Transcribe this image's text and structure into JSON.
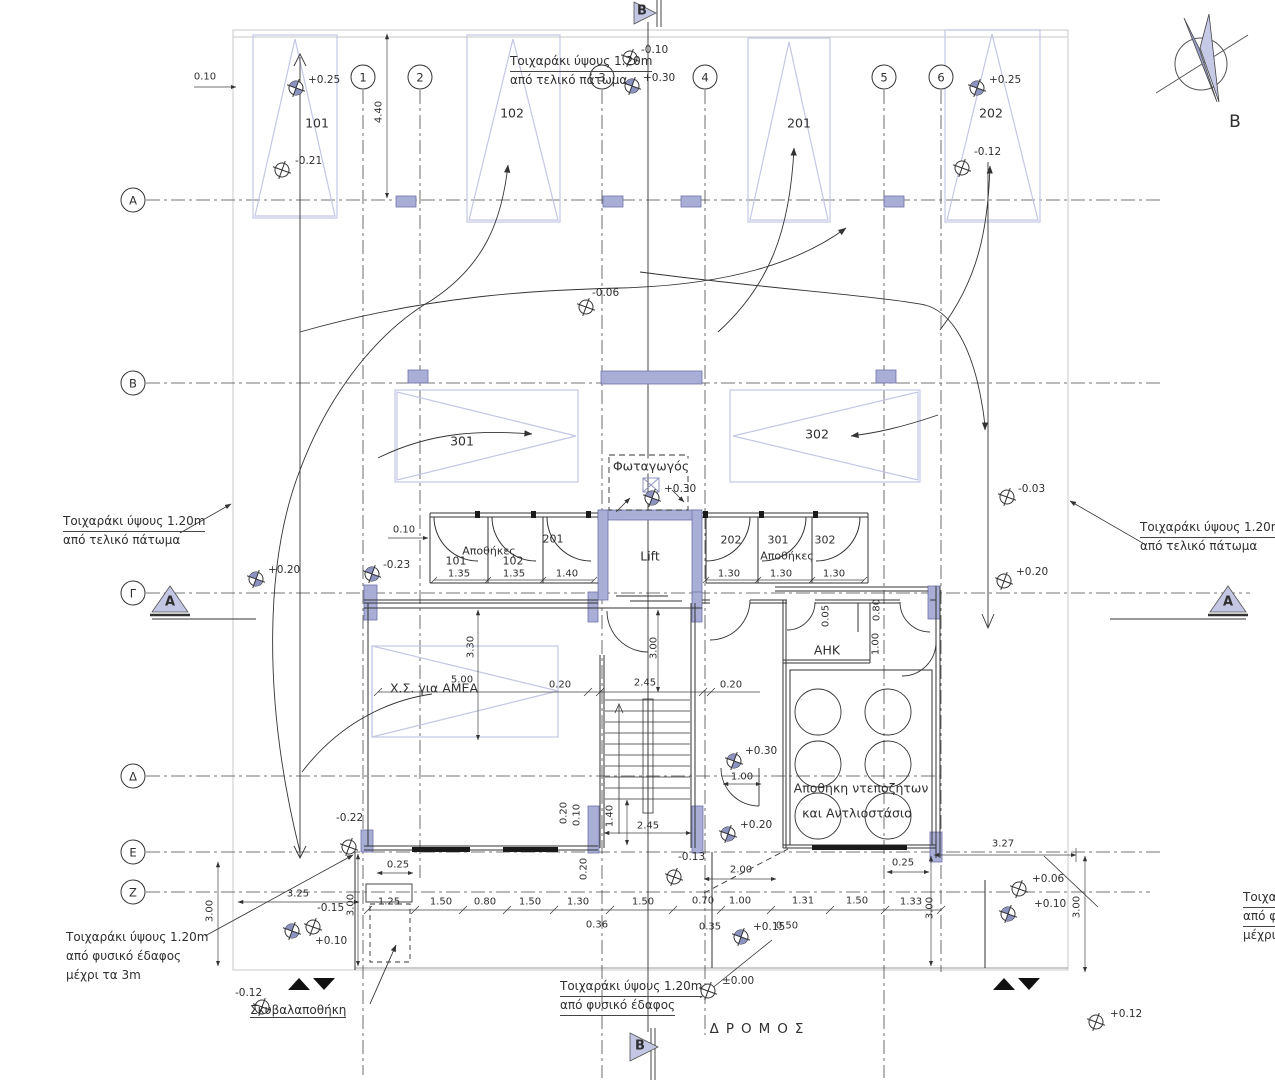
{
  "north": {
    "label": "Β"
  },
  "road_label": "ΔΡΟΜΟΣ",
  "section_markers": {
    "top": "Β",
    "bottom": "Β",
    "left": "Α",
    "right": "Α"
  },
  "grid": {
    "cols": [
      "1",
      "2",
      "3",
      "4",
      "5",
      "6"
    ],
    "rows": [
      "Α",
      "Β",
      "Γ",
      "Δ",
      "Ε",
      "Ζ"
    ]
  },
  "parking": {
    "p101": "101",
    "p102": "102",
    "p201": "201",
    "p202": "202",
    "p301": "301",
    "p302": "302",
    "accessible": "Χ.Σ. για ΑΜΕΑ"
  },
  "rooms": {
    "lightwell": "Φωταγωγός",
    "lift": "Lift",
    "storage_left": "Αποθήκες",
    "storage_right": "Αποθήκες",
    "cell_101": "101",
    "cell_102": "102",
    "cell_201": "201",
    "cell_202": "202",
    "cell_301": "301",
    "cell_302": "302",
    "ahk": "ΑΗΚ",
    "tank_line1": "Αποθήκη ντεποζήτων",
    "tank_line2": "και Αντλιοστάσιο",
    "garbage": "Σκυβαλαποθήκη"
  },
  "notes": {
    "top": [
      "Τοιχαράκι ύψους  1.20m",
      "από τελικό πάτωμα"
    ],
    "left_mid": [
      "Τοιχαράκι ύψους  1.20m",
      "από τελικό πάτωμα"
    ],
    "right_mid": [
      "Τοιχαράκι ύψους  1.20m",
      "από τελικό πάτωμα"
    ],
    "left_bottom": [
      "Τοιχαράκι ύψους  1.20m",
      "από φυσικό έδαφος",
      "μέχρι τα 3m"
    ],
    "bottom_center": [
      "Τοιχαράκι ύψους  1.20m",
      "από φυσικό έδαφος"
    ],
    "right_bottom": [
      "Τοιχαράκι ύψους  1.20m",
      "από φυσικό έδαφος",
      "μέχρι τα 3m"
    ]
  },
  "elevations": [
    {
      "v": "+0.25",
      "tx": 308,
      "ty": 80,
      "sx": 296,
      "sy": 88,
      "f": 1
    },
    {
      "v": "-0.21",
      "tx": 295,
      "ty": 161,
      "sx": 282,
      "sy": 170,
      "f": 0
    },
    {
      "v": "-0.10",
      "tx": 641,
      "ty": 50,
      "sx": 630,
      "sy": 58,
      "f": 0
    },
    {
      "v": "+0.30",
      "tx": 643,
      "ty": 78,
      "sx": 632,
      "sy": 86,
      "f": 1
    },
    {
      "v": "+0.25",
      "tx": 989,
      "ty": 80,
      "sx": 977,
      "sy": 88,
      "f": 1
    },
    {
      "v": "-0.12",
      "tx": 974,
      "ty": 152,
      "sx": 962,
      "sy": 168,
      "f": 0
    },
    {
      "v": "-0.06",
      "tx": 592,
      "ty": 293,
      "sx": 586,
      "sy": 307,
      "f": 0
    },
    {
      "v": "-0.03",
      "tx": 1018,
      "ty": 489,
      "sx": 1007,
      "sy": 497,
      "f": 0
    },
    {
      "v": "+0.20",
      "tx": 268,
      "ty": 570,
      "sx": 256,
      "sy": 579,
      "f": 1
    },
    {
      "v": "-0.23",
      "tx": 383,
      "ty": 565,
      "sx": 372,
      "sy": 574,
      "f": 1
    },
    {
      "v": "+0.20",
      "tx": 1016,
      "ty": 572,
      "sx": 1004,
      "sy": 581,
      "f": 0
    },
    {
      "v": "+0.30",
      "tx": 664,
      "ty": 489,
      "sx": 652,
      "sy": 498,
      "f": 1
    },
    {
      "v": "+0.30",
      "tx": 745,
      "ty": 751,
      "sx": 734,
      "sy": 761,
      "f": 1
    },
    {
      "v": "+0.20",
      "tx": 740,
      "ty": 825,
      "sx": 728,
      "sy": 834,
      "f": 1
    },
    {
      "v": "-0.22",
      "tx": 336,
      "ty": 818,
      "sx": 349,
      "sy": 847,
      "f": 0
    },
    {
      "v": "-0.13",
      "tx": 678,
      "ty": 857,
      "sx": 674,
      "sy": 877,
      "f": 0
    },
    {
      "v": "+0.15",
      "tx": 753,
      "ty": 927,
      "sx": 741,
      "sy": 937,
      "f": 1
    },
    {
      "v": "-0.15",
      "tx": 317,
      "ty": 908,
      "sx": 313,
      "sy": 927,
      "f": 0
    },
    {
      "v": "+0.10",
      "tx": 315,
      "ty": 941,
      "sx": 292,
      "sy": 931,
      "f": 1
    },
    {
      "v": "-0.12",
      "tx": 235,
      "ty": 993,
      "sx": 262,
      "sy": 1007,
      "f": 0
    },
    {
      "v": "±0.00",
      "tx": 722,
      "ty": 981,
      "sx": 708,
      "sy": 991,
      "f": 0
    },
    {
      "v": "+0.06",
      "tx": 1032,
      "ty": 879,
      "sx": 1019,
      "sy": 889,
      "f": 0
    },
    {
      "v": "+0.10",
      "tx": 1034,
      "ty": 904,
      "sx": 1008,
      "sy": 914,
      "f": 1
    },
    {
      "v": "+0.12",
      "tx": 1110,
      "ty": 1014,
      "sx": 1096,
      "sy": 1022,
      "f": 0
    }
  ],
  "dims": [
    {
      "v": "0.10",
      "x": 205,
      "y": 77
    },
    {
      "v": "4.40",
      "x": 379,
      "y": 112,
      "r": 1
    },
    {
      "v": "0.10",
      "x": 404,
      "y": 530
    },
    {
      "v": "1.35",
      "x": 459,
      "y": 574
    },
    {
      "v": "1.35",
      "x": 514,
      "y": 574
    },
    {
      "v": "1.40",
      "x": 567,
      "y": 574
    },
    {
      "v": "1.30",
      "x": 729,
      "y": 574
    },
    {
      "v": "1.30",
      "x": 781,
      "y": 574
    },
    {
      "v": "1.30",
      "x": 834,
      "y": 574
    },
    {
      "v": "5.00",
      "x": 462,
      "y": 680
    },
    {
      "v": "0.20",
      "x": 560,
      "y": 685
    },
    {
      "v": "2.45",
      "x": 645,
      "y": 683
    },
    {
      "v": "0.20",
      "x": 731,
      "y": 685
    },
    {
      "v": "3.30",
      "x": 471,
      "y": 647,
      "r": 1
    },
    {
      "v": "3.00",
      "x": 654,
      "y": 648,
      "r": 1
    },
    {
      "v": "0.20",
      "x": 564,
      "y": 813,
      "r": 1
    },
    {
      "v": "0.10",
      "x": 577,
      "y": 815,
      "r": 1
    },
    {
      "v": "1.40",
      "x": 610,
      "y": 816,
      "r": 1
    },
    {
      "v": "0.20",
      "x": 584,
      "y": 869,
      "r": 1
    },
    {
      "v": "2.45",
      "x": 648,
      "y": 826
    },
    {
      "v": "1.00",
      "x": 742,
      "y": 777
    },
    {
      "v": "0.05",
      "x": 826,
      "y": 616,
      "r": 1
    },
    {
      "v": "0.80",
      "x": 877,
      "y": 610,
      "r": 1
    },
    {
      "v": "1.00",
      "x": 876,
      "y": 644,
      "r": 1
    },
    {
      "v": "2.00",
      "x": 741,
      "y": 870
    },
    {
      "v": "0.25",
      "x": 398,
      "y": 865
    },
    {
      "v": "0.25",
      "x": 903,
      "y": 863
    },
    {
      "v": "3.25",
      "x": 298,
      "y": 894
    },
    {
      "v": "3.27",
      "x": 1003,
      "y": 844
    },
    {
      "v": "3.00",
      "x": 210,
      "y": 911,
      "r": 1
    },
    {
      "v": "3.00",
      "x": 351,
      "y": 905,
      "r": 1
    },
    {
      "v": "3.00",
      "x": 930,
      "y": 908,
      "r": 1
    },
    {
      "v": "3.00",
      "x": 1077,
      "y": 907,
      "r": 1
    },
    {
      "v": "1.25",
      "x": 389,
      "y": 902
    },
    {
      "v": "1.50",
      "x": 441,
      "y": 902
    },
    {
      "v": "0.80",
      "x": 485,
      "y": 902
    },
    {
      "v": "1.50",
      "x": 530,
      "y": 902
    },
    {
      "v": "1.30",
      "x": 578,
      "y": 902
    },
    {
      "v": "1.50",
      "x": 643,
      "y": 902
    },
    {
      "v": "0.70",
      "x": 703,
      "y": 901
    },
    {
      "v": "1.00",
      "x": 740,
      "y": 901
    },
    {
      "v": "1.31",
      "x": 803,
      "y": 901
    },
    {
      "v": "1.50",
      "x": 857,
      "y": 901
    },
    {
      "v": "1.33",
      "x": 911,
      "y": 902
    },
    {
      "v": "0.36",
      "x": 597,
      "y": 925
    },
    {
      "v": "0.35",
      "x": 710,
      "y": 927
    },
    {
      "v": "0.50",
      "x": 787,
      "y": 926
    }
  ]
}
